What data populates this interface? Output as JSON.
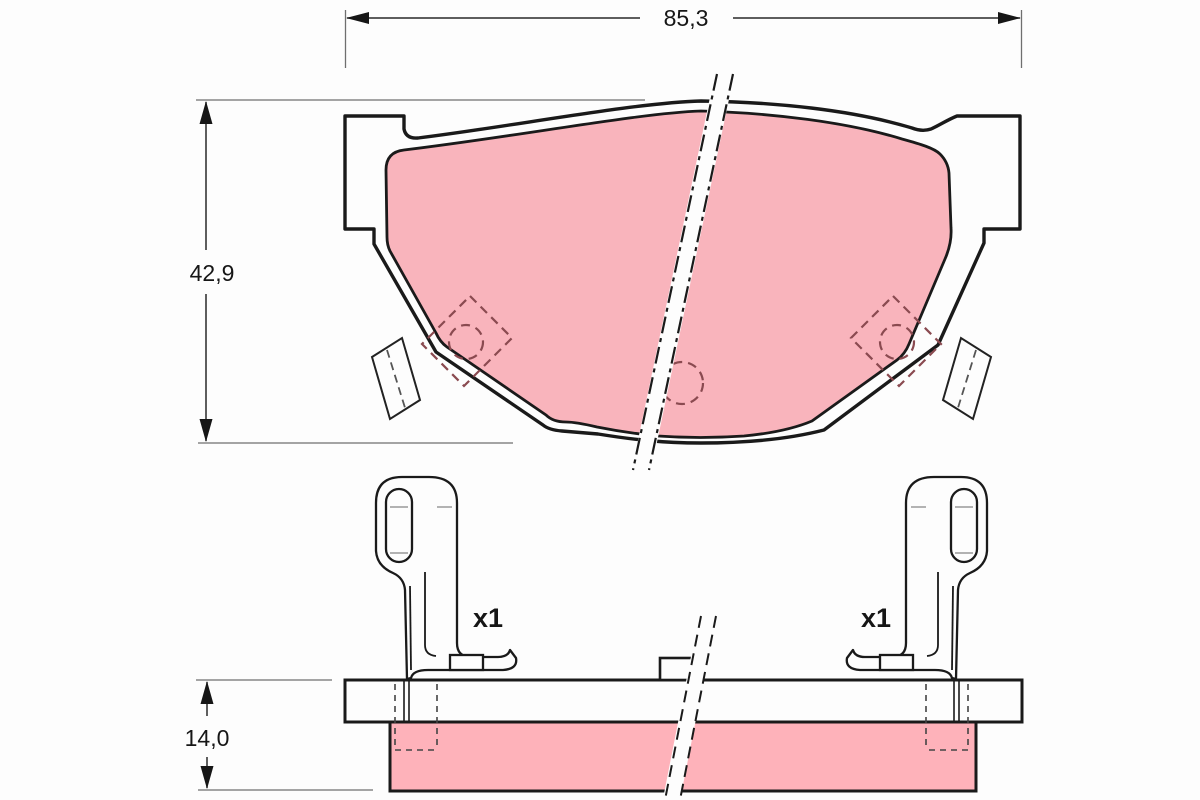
{
  "drawing": {
    "type": "brake-pad-technical-drawing",
    "views": {
      "front_view": "brake pad front face with backing plate, friction material, guide tabs and wear-indicator positions",
      "side_view": "brake pad edge view with anti-rattle spring clips"
    },
    "dimensions": {
      "width": "85,3",
      "height": "42,9",
      "thickness": "14,0"
    },
    "labels": {
      "left_clip_quantity": "x1",
      "right_clip_quantity": "x1"
    },
    "colors": {
      "friction_material_front": "#f9b4bc",
      "friction_material_side": "#feb2ba",
      "outline": "#1a1a1a",
      "dimension_line": "#2a2a2a",
      "extension_line": "#6f6f6f",
      "hidden_detail_dash": "#8a4a50",
      "background": "#fdfdfd"
    }
  }
}
